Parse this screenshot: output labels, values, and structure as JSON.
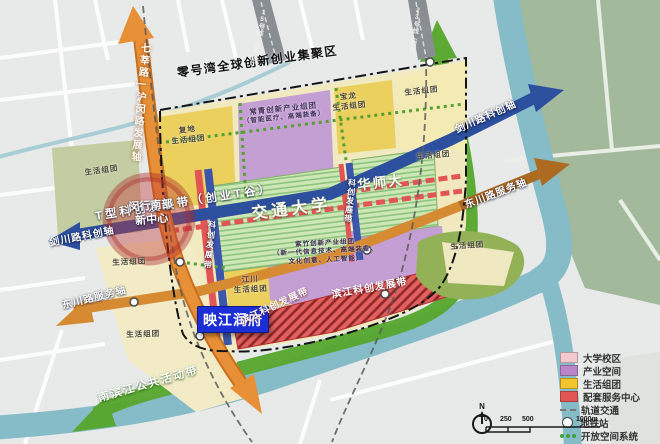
{
  "map": {
    "boundary_label": "零号湾全球创新创业集聚区",
    "corridors": {
      "t_band": "T型科创发展带（创业T谷）",
      "v_band_left": "科创发展带",
      "v_band_right": "科创发展带",
      "binjiang_a": "滨江科创发展带",
      "binjiang_b": "滨江科创发展带",
      "nanbinjiang": "南滨江公共活动带"
    },
    "axes": {
      "jianchuan_left": "剑川路科创轴",
      "jianchuan_right": "剑川路科创轴",
      "dongchuan_left": "东川路服务轴",
      "dongchuan_right": "东川路服务轴",
      "qixin_humin": "七莘路—沪闵路发展轴"
    },
    "universities": {
      "jiaotong": "交通大学",
      "huashida": "华师大"
    },
    "center_marker": {
      "line1": "闵行南部",
      "line2": "新中心"
    },
    "property_marker": "映江润府",
    "clusters": {
      "life_nw": "生活组团",
      "fudi_1": "复地",
      "fudi_2": "生活组团",
      "changqing_1": "常青创新产业组团",
      "changqing_2": "（智能医疗、高端装备）",
      "baolong_1": "宝龙",
      "baolong_2": "生活组团",
      "life_ne": "生活组团",
      "life_e": "生活组团",
      "life_w": "生活组团",
      "life_sw": "生活组团",
      "jiangchuan_1": "江川",
      "jiangchuan_2": "生活组团",
      "zizhu_1": "紫竹创新产业组团",
      "zizhu_2": "（新一代信息技术、高端装备、",
      "zizhu_3": "文化创意、人工智能）",
      "life_se": "生活组团"
    },
    "transit": {
      "line15": "15号线（延伸段）",
      "line23": "23号线（规划）"
    }
  },
  "legend": {
    "items": [
      {
        "label": "大学校区",
        "swatch": "#f4c9ce",
        "type": "rect"
      },
      {
        "label": "产业空间",
        "swatch": "#bb85ca",
        "type": "rect"
      },
      {
        "label": "生活组团",
        "swatch": "#f2c52e",
        "type": "rect"
      },
      {
        "label": "配套服务中心",
        "swatch": "#e25555",
        "type": "rect"
      },
      {
        "label": "轨道交通",
        "type": "dash"
      },
      {
        "label": "地铁站",
        "type": "circle"
      },
      {
        "label": "开放空间系统",
        "type": "dots",
        "dot_color": "#3da43c"
      }
    ]
  },
  "scalebar": {
    "ticks": [
      "0",
      "250",
      "500",
      "1000m"
    ]
  },
  "compass": {
    "north": "N"
  },
  "colors": {
    "marker_bg": "#1c2fd6",
    "river": "#85bcc8",
    "open_space_green": "#58a72f",
    "sci_axis_blue": "#2c4f9e",
    "service_axis_orange": "#d68a32",
    "humin_road_orange": "#e89038",
    "center_red": "#c23b3b"
  }
}
